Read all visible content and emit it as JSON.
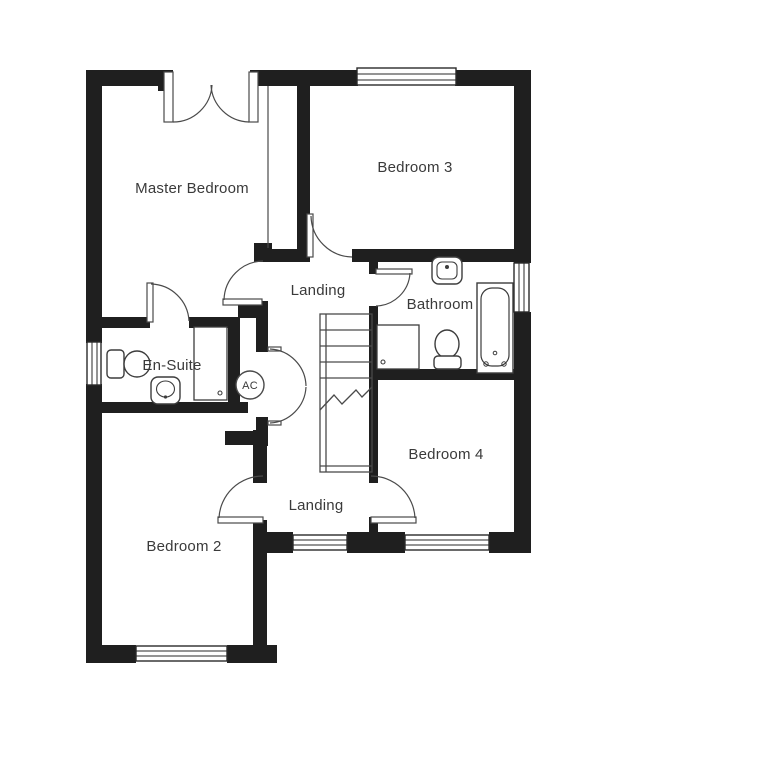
{
  "plan": {
    "type": "first-floor-plan",
    "rooms": [
      {
        "name": "master-bedroom",
        "label": "Master Bedroom"
      },
      {
        "name": "bedroom-3",
        "label": "Bedroom 3"
      },
      {
        "name": "landing-upper",
        "label": "Landing"
      },
      {
        "name": "bathroom",
        "label": "Bathroom"
      },
      {
        "name": "en-suite",
        "label": "En-Suite"
      },
      {
        "name": "bedroom-4",
        "label": "Bedroom 4"
      },
      {
        "name": "landing-lower",
        "label": "Landing"
      },
      {
        "name": "bedroom-2",
        "label": "Bedroom 2"
      }
    ],
    "cupboard_label": "AC",
    "fixtures": {
      "en_suite": [
        "toilet",
        "wash-basin",
        "shower-enclosure"
      ],
      "bathroom": [
        "wash-basin",
        "bath",
        "toilet",
        "shower-enclosure"
      ],
      "circulation": [
        "staircase",
        "airing-cupboard"
      ]
    },
    "colors": {
      "wall": "#1f1f1f",
      "thin_line": "#4a4a4a",
      "text": "#3a3a3a",
      "background": "#ffffff"
    }
  }
}
